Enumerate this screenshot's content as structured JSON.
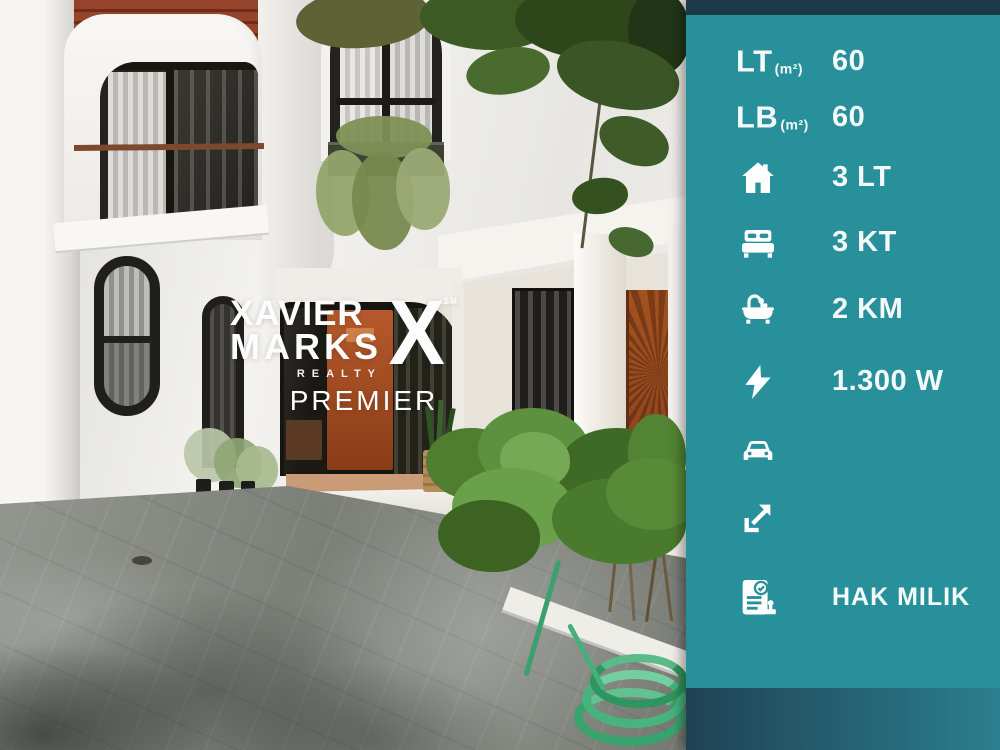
{
  "panel": {
    "rows": [
      {
        "label": "LT",
        "unit": "(m²)",
        "value": "60"
      },
      {
        "label": "LB",
        "unit": "(m²)",
        "value": "60"
      },
      {
        "icon": "house-icon",
        "value": "3 LT"
      },
      {
        "icon": "bed-icon",
        "value": "3 KT"
      },
      {
        "icon": "bath-icon",
        "value": "2 KM"
      },
      {
        "icon": "lightning-icon",
        "value": "1.300 W"
      },
      {
        "icon": "car-icon",
        "value": ""
      },
      {
        "icon": "direction-arrow-icon",
        "value": ""
      },
      {
        "icon": "certificate-icon",
        "value": "HAK MILIK"
      }
    ],
    "colors": {
      "panel_bg": "#28909b",
      "top_strip": "#1c3a49",
      "bottom_strip_left": "#1f4254",
      "bottom_strip_right": "#2b7f8e",
      "text": "#f4fafa"
    }
  },
  "watermark": {
    "line1": "XAVIER",
    "line2": "MARKS",
    "x_mark": "X",
    "sm": "SM",
    "realty": "REALTY",
    "premier": "PREMIER"
  }
}
